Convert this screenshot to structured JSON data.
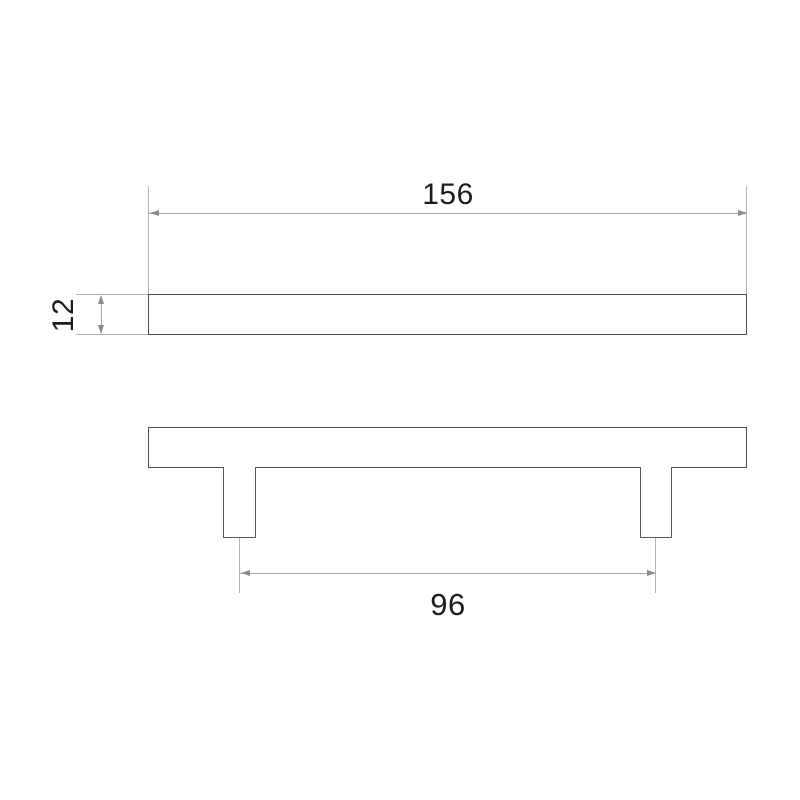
{
  "drawing": {
    "kind": "technical-dimension-drawing",
    "dimensions": {
      "length": {
        "value": "156",
        "axis": "horizontal",
        "view": "top"
      },
      "thickness": {
        "value": "12",
        "axis": "vertical",
        "view": "top"
      },
      "spacing": {
        "value": "96",
        "axis": "horizontal",
        "view": "front"
      }
    },
    "colors": {
      "background": "#ffffff",
      "part_outline": "#4f4f4f",
      "dimension_line": "#a6a6a6",
      "extension_line": "#b3b3b3",
      "arrowhead": "#8a8a8a",
      "label_text": "#1c1c1c"
    }
  }
}
